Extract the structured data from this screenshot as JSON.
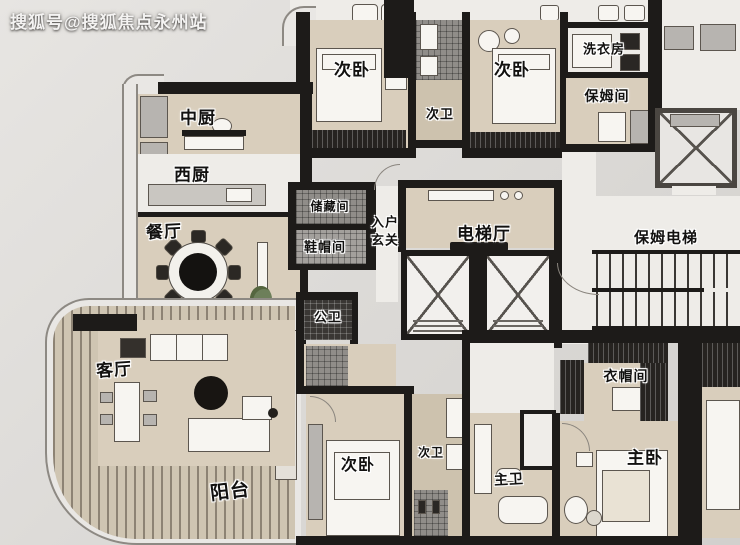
{
  "watermark": "搜狐号@搜狐焦点永州站",
  "rooms": {
    "bedroom2_top_left": "次卧",
    "bedroom2_top_right": "次卧",
    "bath2_top": "次卫",
    "laundry_room": "洗衣房",
    "nanny_room": "保姆间",
    "chinese_kitchen": "中厨",
    "western_kitchen": "西厨",
    "dining_room": "餐厅",
    "storage_room": "储藏间",
    "shoe_hat_room": "鞋帽间",
    "entry_foyer_line1": "入户",
    "entry_foyer_line2": "玄关",
    "elevator_hall": "电梯厅",
    "nanny_elevator": "保姆电梯",
    "public_bath": "公卫",
    "living_room": "客厅",
    "balcony": "阳台",
    "bedroom2_bottom": "次卧",
    "bath2_bottom": "次卫",
    "master_bath": "主卫",
    "cloakroom": "衣帽间",
    "master_bedroom": "主卧"
  },
  "colors": {
    "wall": "#1d1b19",
    "floor_wood": "#d9cebc",
    "background": "#dddbd8",
    "label_text": "#121110",
    "label_halo": "#ffffff",
    "balcony_slat": "#8d8374"
  }
}
